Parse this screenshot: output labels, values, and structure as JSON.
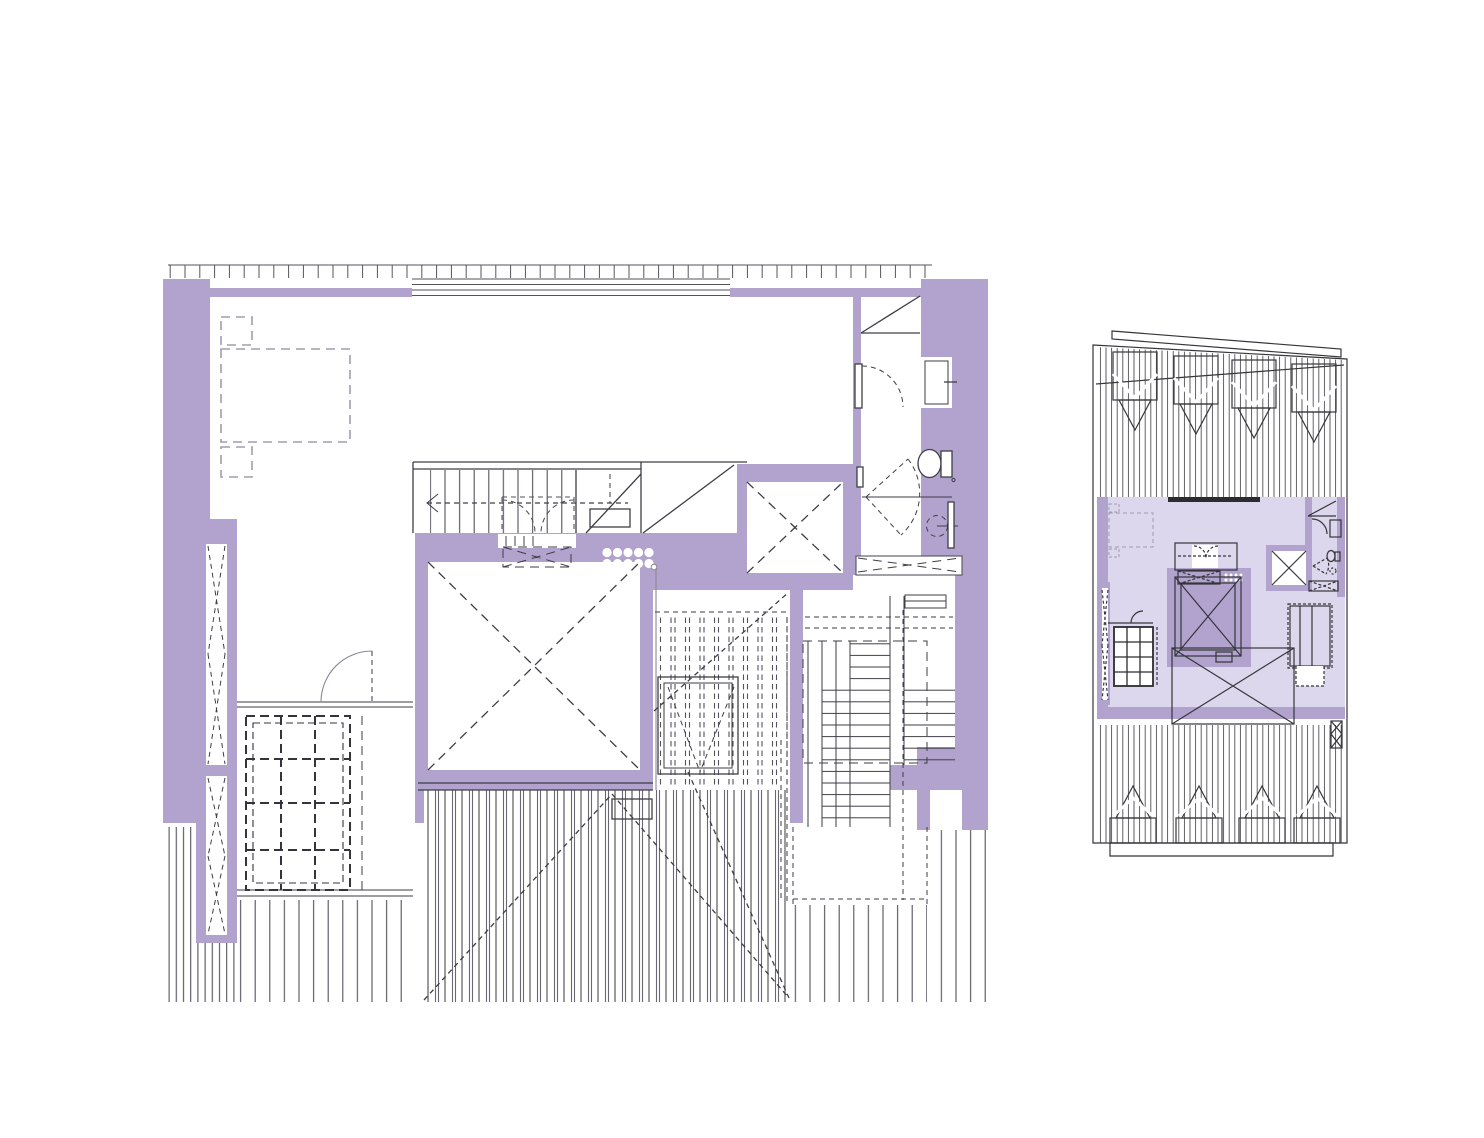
{
  "document": {
    "kind": "architectural drawing sheet",
    "sheets": [
      {
        "id": "main-floor-plan",
        "description": "enlarged penthouse / attic floor plan with elevator core, central stair, bathroom, dressing room with skylight grid, and surrounding roof decks"
      },
      {
        "id": "key-plan",
        "description": "small key plan of the whole building footprint with the unit highlighted and roof dormers above and below"
      }
    ]
  },
  "palette": {
    "background": "#ffffff",
    "wall_purple": "#b1a3cd",
    "unit_highlight": "#dcd7ec",
    "line_dark": "#3e3e46",
    "line_mid": "#55525c",
    "line_gray": "#8a8794",
    "furniture_dash": "#a09db0",
    "glazing_bar": "#2c2c30"
  },
  "main_plan": {
    "elements": [
      "terrace-railing-ticks",
      "sliding-glazing-lines",
      "bedroom-bed-dashed",
      "nightstands-dashed",
      "louver-slots-with-bowtie",
      "dressing-room-partition",
      "dressing-door-swing",
      "skylight-grid-dashed",
      "central-stair-treads",
      "stair-walk-line-arrow",
      "closet-double-doors-dashed",
      "vent-bowtie-dashed",
      "spot-dots-cluster",
      "elevator-shaft-dashed-x",
      "duct-shaft-dashed-x",
      "under-stair-diagonals",
      "skylight-void-dashed-hatch",
      "skylight-frame",
      "bathroom-sink",
      "bathroom-toilet",
      "bathroom-doors",
      "floor-drain",
      "radiator",
      "bathroom-bowtie-dashed",
      "secondary-stair-treads",
      "stair-landing-dashed",
      "roof-deck-hatches",
      "roof-slope-dashed-diagonals",
      "headroom-diagonal-lines"
    ]
  },
  "key_plan": {
    "elements": [
      "building-outline-sloped-cap",
      "upper-roof-hatch",
      "upper-dormers-x4",
      "unit-highlight-fill",
      "mini-bed",
      "mini-stair",
      "mini-elevator-x",
      "mini-duct-x",
      "mini-bathroom",
      "mini-skylight-grid",
      "central-roof-x-hatch",
      "mini-secondary-stair",
      "lower-roof-hatch",
      "lower-dormers-x4",
      "edge-louver-bowtie",
      "bottom-cap-band"
    ]
  }
}
